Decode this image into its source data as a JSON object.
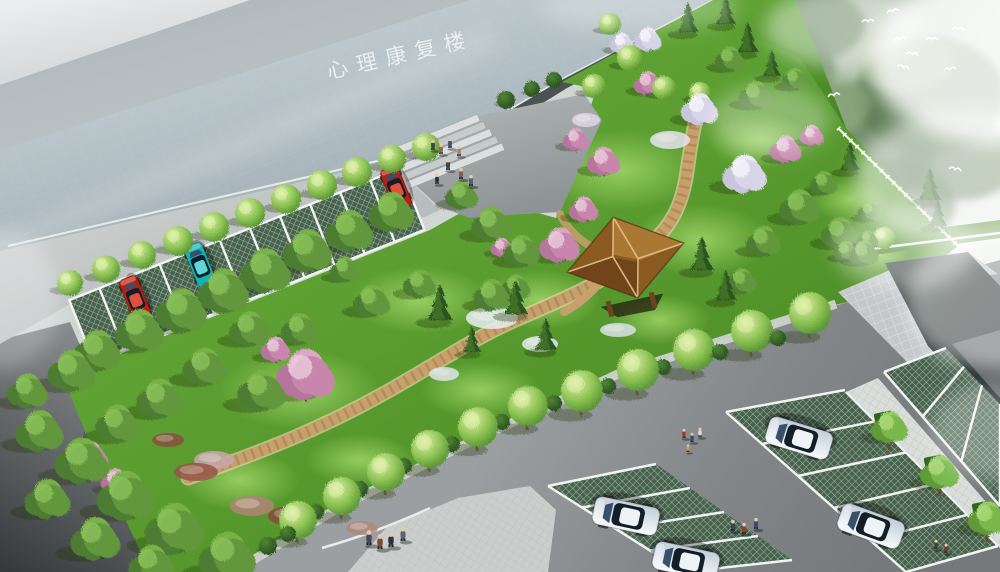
{
  "meta": {
    "type": "landscape-architecture-aerial-rendering"
  },
  "building": {
    "label": "心理康复楼"
  },
  "palette": {
    "roof_slab_light": "#cdd8db",
    "roof_slab_dark": "#93a2a9",
    "hill_dark": "#78927a",
    "hill_light": "#e9eee8",
    "lawn_light": "#6cb03c",
    "lawn_dark": "#3f7c1c",
    "road_main": "#84888a",
    "road_dark": "#34383a",
    "road_left": "#c9cecd",
    "paver_green": "#47634d",
    "stall_line": "#f2f4f2",
    "path_tan": "#c8a06c",
    "path_edge": "#e7d6b0",
    "plaza": "#a6abac",
    "pavilion_roof": "#9c6c2c",
    "pavilion_ridge": "#e2c088",
    "car_red": "#c41a0c",
    "car_teal": "#12b4b4",
    "car_white": "#eef3f7",
    "walkway": "#dadeda",
    "apron": "#c4c8ca",
    "fence": "#ffffff",
    "bird": "#ffffff",
    "mist": "#ffffff",
    "label_text": "#eff4f5"
  },
  "scene": {
    "trees": [
      [
        "st",
        70,
        283,
        13
      ],
      [
        "st",
        106,
        269,
        14
      ],
      [
        "st",
        142,
        255,
        14
      ],
      [
        "st",
        178,
        241,
        15
      ],
      [
        "st",
        214,
        227,
        15
      ],
      [
        "st",
        250,
        213,
        15
      ],
      [
        "st",
        286,
        199,
        15
      ],
      [
        "st",
        322,
        185,
        15
      ],
      [
        "st",
        357,
        172,
        15
      ],
      [
        "st",
        392,
        159,
        14
      ],
      [
        "st",
        426,
        147,
        14
      ],
      [
        "st",
        630,
        58,
        13
      ],
      [
        "st",
        594,
        86,
        12
      ],
      [
        "st",
        664,
        88,
        12
      ],
      [
        "st",
        700,
        93,
        11
      ],
      [
        "st",
        610,
        24,
        11
      ],
      [
        "st",
        884,
        238,
        11
      ],
      [
        "stt",
        298,
        520,
        19
      ],
      [
        "stt",
        342,
        496,
        19
      ],
      [
        "stt",
        386,
        472,
        19
      ],
      [
        "stt",
        430,
        449,
        19
      ],
      [
        "stt",
        478,
        427,
        20
      ],
      [
        "stt",
        528,
        406,
        20
      ],
      [
        "stt",
        582,
        391,
        21
      ],
      [
        "stt",
        638,
        370,
        21
      ],
      [
        "stt",
        694,
        350,
        21
      ],
      [
        "stt",
        752,
        331,
        21
      ],
      [
        "stt",
        810,
        313,
        21
      ],
      [
        "fl",
        98,
        352,
        26
      ],
      [
        "fl",
        140,
        332,
        27
      ],
      [
        "fl",
        182,
        312,
        28
      ],
      [
        "fl",
        224,
        292,
        28
      ],
      [
        "fl",
        266,
        272,
        28
      ],
      [
        "fl",
        308,
        252,
        27
      ],
      [
        "fl",
        350,
        232,
        26
      ],
      [
        "fl",
        392,
        213,
        25
      ],
      [
        "fl",
        72,
        372,
        26
      ],
      [
        "fl",
        40,
        432,
        26
      ],
      [
        "fl",
        82,
        462,
        29
      ],
      [
        "fl",
        126,
        497,
        31
      ],
      [
        "fl",
        175,
        530,
        32
      ],
      [
        "fl",
        228,
        558,
        31
      ],
      [
        "fl",
        48,
        500,
        25
      ],
      [
        "fl",
        96,
        540,
        27
      ],
      [
        "fl",
        152,
        566,
        25
      ],
      [
        "fl",
        28,
        392,
        22
      ],
      [
        "fl",
        250,
        330,
        22
      ],
      [
        "fl",
        205,
        368,
        24
      ],
      [
        "fl",
        160,
        400,
        25
      ],
      [
        "fl",
        118,
        425,
        24
      ],
      [
        "fl",
        300,
        330,
        20
      ],
      [
        "fl",
        262,
        392,
        26
      ],
      [
        "fl",
        372,
        302,
        20
      ],
      [
        "fl",
        420,
        285,
        18
      ],
      [
        "fl",
        345,
        270,
        16
      ],
      [
        "fl",
        462,
        196,
        18
      ],
      [
        "fl",
        492,
        225,
        22
      ],
      [
        "fl",
        522,
        252,
        20
      ],
      [
        "fl",
        756,
        96,
        18
      ],
      [
        "fl",
        730,
        60,
        16
      ],
      [
        "fl",
        795,
        80,
        14
      ],
      [
        "fl",
        800,
        208,
        22
      ],
      [
        "fl",
        840,
        234,
        20
      ],
      [
        "fl",
        864,
        254,
        16
      ],
      [
        "fl",
        764,
        242,
        19
      ],
      [
        "fl",
        824,
        184,
        15
      ],
      [
        "fl",
        870,
        212,
        13
      ],
      [
        "fl",
        742,
        282,
        16
      ],
      [
        "fl",
        492,
        296,
        20
      ],
      [
        "fl",
        516,
        288,
        16
      ],
      [
        "fl",
        846,
        252,
        13
      ],
      [
        "fl",
        868,
        240,
        11
      ],
      [
        "co",
        688,
        32,
        30
      ],
      [
        "co",
        726,
        24,
        28
      ],
      [
        "co",
        748,
        52,
        30
      ],
      [
        "co",
        772,
        76,
        26
      ],
      [
        "co",
        850,
        170,
        28
      ],
      [
        "co",
        930,
        200,
        32
      ],
      [
        "co",
        938,
        226,
        26
      ],
      [
        "co",
        702,
        270,
        34
      ],
      [
        "co",
        726,
        300,
        30
      ],
      [
        "co",
        440,
        320,
        36
      ],
      [
        "co",
        516,
        314,
        34
      ],
      [
        "co",
        546,
        350,
        32
      ],
      [
        "co",
        472,
        352,
        26
      ],
      [
        "bp",
        306,
        376,
        32
      ],
      [
        "bp",
        276,
        350,
        16
      ],
      [
        "bp",
        560,
        246,
        22
      ],
      [
        "bp",
        584,
        210,
        16
      ],
      [
        "bp",
        604,
        162,
        18
      ],
      [
        "bp",
        576,
        140,
        14
      ],
      [
        "bp",
        502,
        248,
        12
      ],
      [
        "bp",
        648,
        84,
        15
      ],
      [
        "bp",
        786,
        150,
        17
      ],
      [
        "bp",
        812,
        136,
        13
      ],
      [
        "bp",
        90,
        458,
        20
      ],
      [
        "bp",
        116,
        482,
        16
      ],
      [
        "bw",
        648,
        40,
        15
      ],
      [
        "bw",
        622,
        44,
        13
      ],
      [
        "bw",
        700,
        110,
        20
      ],
      [
        "bw",
        745,
        175,
        24
      ],
      [
        "sh",
        316,
        512,
        8
      ],
      [
        "sh",
        360,
        489,
        8
      ],
      [
        "sh",
        404,
        466,
        8
      ],
      [
        "sh",
        452,
        444,
        8
      ],
      [
        "sh",
        502,
        422,
        8
      ],
      [
        "sh",
        554,
        403,
        8
      ],
      [
        "sh",
        608,
        386,
        8
      ],
      [
        "sh",
        663,
        367,
        8
      ],
      [
        "sh",
        720,
        352,
        8
      ],
      [
        "sh",
        778,
        338,
        8
      ],
      [
        "sh",
        268,
        546,
        9
      ],
      [
        "sh",
        288,
        534,
        8
      ],
      [
        "sh",
        506,
        100,
        9
      ],
      [
        "sh",
        532,
        89,
        8
      ],
      [
        "sh",
        554,
        80,
        8
      ],
      [
        "wt",
        890,
        428,
        20
      ],
      [
        "wt",
        940,
        473,
        21
      ],
      [
        "wt",
        988,
        519,
        21
      ]
    ],
    "cars": [
      [
        135,
        298,
        -112,
        "red"
      ],
      [
        200,
        265,
        -112,
        "teal"
      ],
      [
        396,
        188,
        -112,
        "red"
      ],
      [
        799,
        438,
        197,
        "white"
      ],
      [
        871,
        526,
        200,
        "white"
      ],
      [
        626,
        516,
        192,
        "white"
      ],
      [
        686,
        561,
        192,
        "white"
      ]
    ],
    "people": [
      [
        433,
        150,
        11,
        "#3a4450"
      ],
      [
        441,
        154,
        11,
        "#8a6a5a"
      ],
      [
        450,
        148,
        11,
        "#46506a"
      ],
      [
        459,
        156,
        11,
        "#9a8a80"
      ],
      [
        448,
        170,
        12,
        "#3a4450"
      ],
      [
        461,
        179,
        12,
        "#8a5a4a"
      ],
      [
        471,
        186,
        12,
        "#50607a"
      ],
      [
        437,
        184,
        11,
        "#2a3440"
      ],
      [
        369,
        545,
        16,
        "#434c56"
      ],
      [
        380,
        549,
        16,
        "#7a4a3a"
      ],
      [
        391,
        547,
        16,
        "#2a3440"
      ],
      [
        403,
        541,
        15,
        "#5a6474"
      ],
      [
        684,
        438,
        10,
        "#b03028"
      ],
      [
        692,
        442,
        10,
        "#2f4a8a"
      ],
      [
        700,
        437,
        10,
        "#d6dde2"
      ],
      [
        688,
        452,
        8,
        "#c8a232"
      ],
      [
        733,
        531,
        12,
        "#3a4456"
      ],
      [
        744,
        534,
        12,
        "#9a3a2e"
      ],
      [
        756,
        529,
        12,
        "#2f4a7a"
      ],
      [
        936,
        549,
        10,
        "#4a3a32"
      ],
      [
        946,
        553,
        10,
        "#6a3a2a"
      ]
    ],
    "birds": [
      [
        893,
        12
      ],
      [
        900,
        40
      ],
      [
        932,
        40
      ],
      [
        912,
        55
      ],
      [
        903,
        68
      ],
      [
        950,
        70
      ],
      [
        868,
        22
      ],
      [
        958,
        30
      ],
      [
        955,
        170
      ],
      [
        834,
        96
      ]
    ],
    "beds": [
      [
        492,
        318,
        26,
        11,
        "#e8edf2"
      ],
      [
        540,
        344,
        18,
        8,
        "#e3e9ef"
      ],
      [
        214,
        460,
        20,
        9,
        "#c8a4ac"
      ],
      [
        252,
        506,
        22,
        10,
        "#b08478"
      ],
      [
        196,
        472,
        22,
        9,
        "#96564a"
      ],
      [
        292,
        516,
        24,
        10,
        "#8a4a3a"
      ],
      [
        362,
        528,
        16,
        7,
        "#b0887a"
      ],
      [
        168,
        440,
        16,
        7,
        "#8a5040"
      ],
      [
        444,
        374,
        15,
        7,
        "#dde4ea"
      ],
      [
        618,
        330,
        18,
        7,
        "#d8e0e6"
      ],
      [
        670,
        140,
        20,
        9,
        "#e6e2ee"
      ],
      [
        586,
        120,
        14,
        7,
        "#e2d6e4"
      ]
    ]
  }
}
